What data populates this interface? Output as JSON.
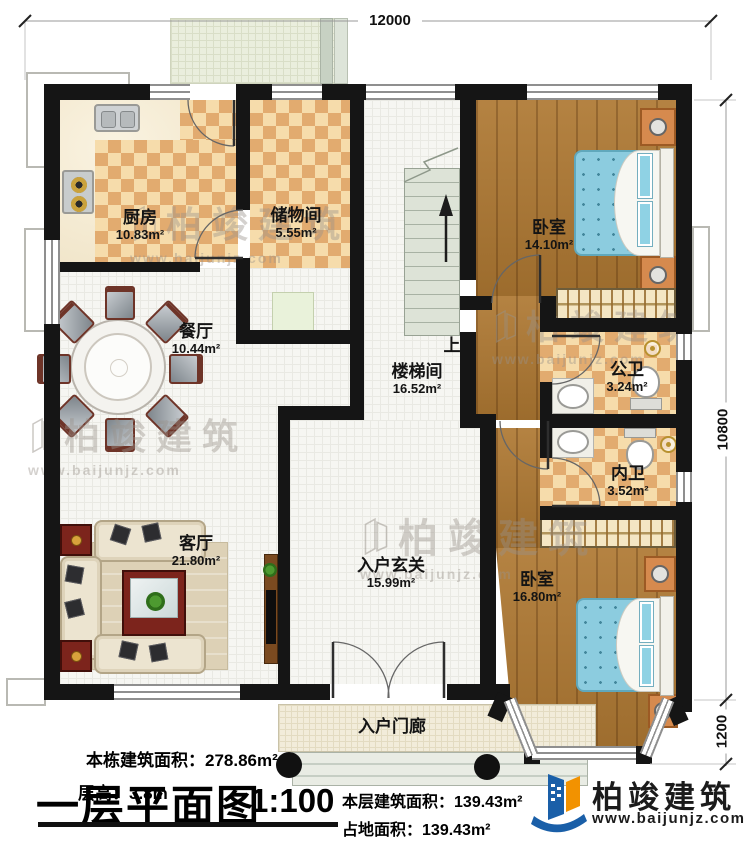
{
  "plan": {
    "dimensions": {
      "top": "12000",
      "right_main": "10800",
      "right_bay": "1200"
    },
    "rooms": {
      "kitchen": {
        "name": "厨房",
        "area": "10.83m²"
      },
      "storage": {
        "name": "储物间",
        "area": "5.55m²"
      },
      "bedroom_top": {
        "name": "卧室",
        "area": "14.10m²"
      },
      "dining": {
        "name": "餐厅",
        "area": "10.44m²"
      },
      "stairwell": {
        "name": "楼梯间",
        "area": "16.52m²",
        "up_label": "上"
      },
      "bath_public": {
        "name": "公卫",
        "area": "3.24m²"
      },
      "bath_inner": {
        "name": "内卫",
        "area": "3.52m²"
      },
      "living": {
        "name": "客厅",
        "area": "21.80m²"
      },
      "foyer": {
        "name": "入户玄关",
        "area": "15.99m²"
      },
      "bedroom_bottom": {
        "name": "卧室",
        "area": "16.80m²"
      },
      "porch": {
        "name": "入户门廊"
      }
    }
  },
  "footer": {
    "building_area_label": "本栋建筑面积：",
    "building_area_value": "278.86m²",
    "floor_height_label": "层高：",
    "floor_height_value": "3.8m",
    "title": "一层平面图",
    "scale": "1:100",
    "floor_area_label": "本层建筑面积：",
    "floor_area_value": "139.43m²",
    "footprint_label": "占地面积：",
    "footprint_value": "139.43m²"
  },
  "brand": {
    "name": "柏竣建筑",
    "website": "www.baijunjz.com"
  },
  "watermark": {
    "name": "柏竣建筑",
    "website": "www.baijunjz.com"
  },
  "colors": {
    "wall": "#151515",
    "brand_blue": "#1a5fa8",
    "brand_orange": "#f29200",
    "bed": "#8cccdf",
    "wood": "#ae7832",
    "checker_dark": "#e2ab6f"
  }
}
